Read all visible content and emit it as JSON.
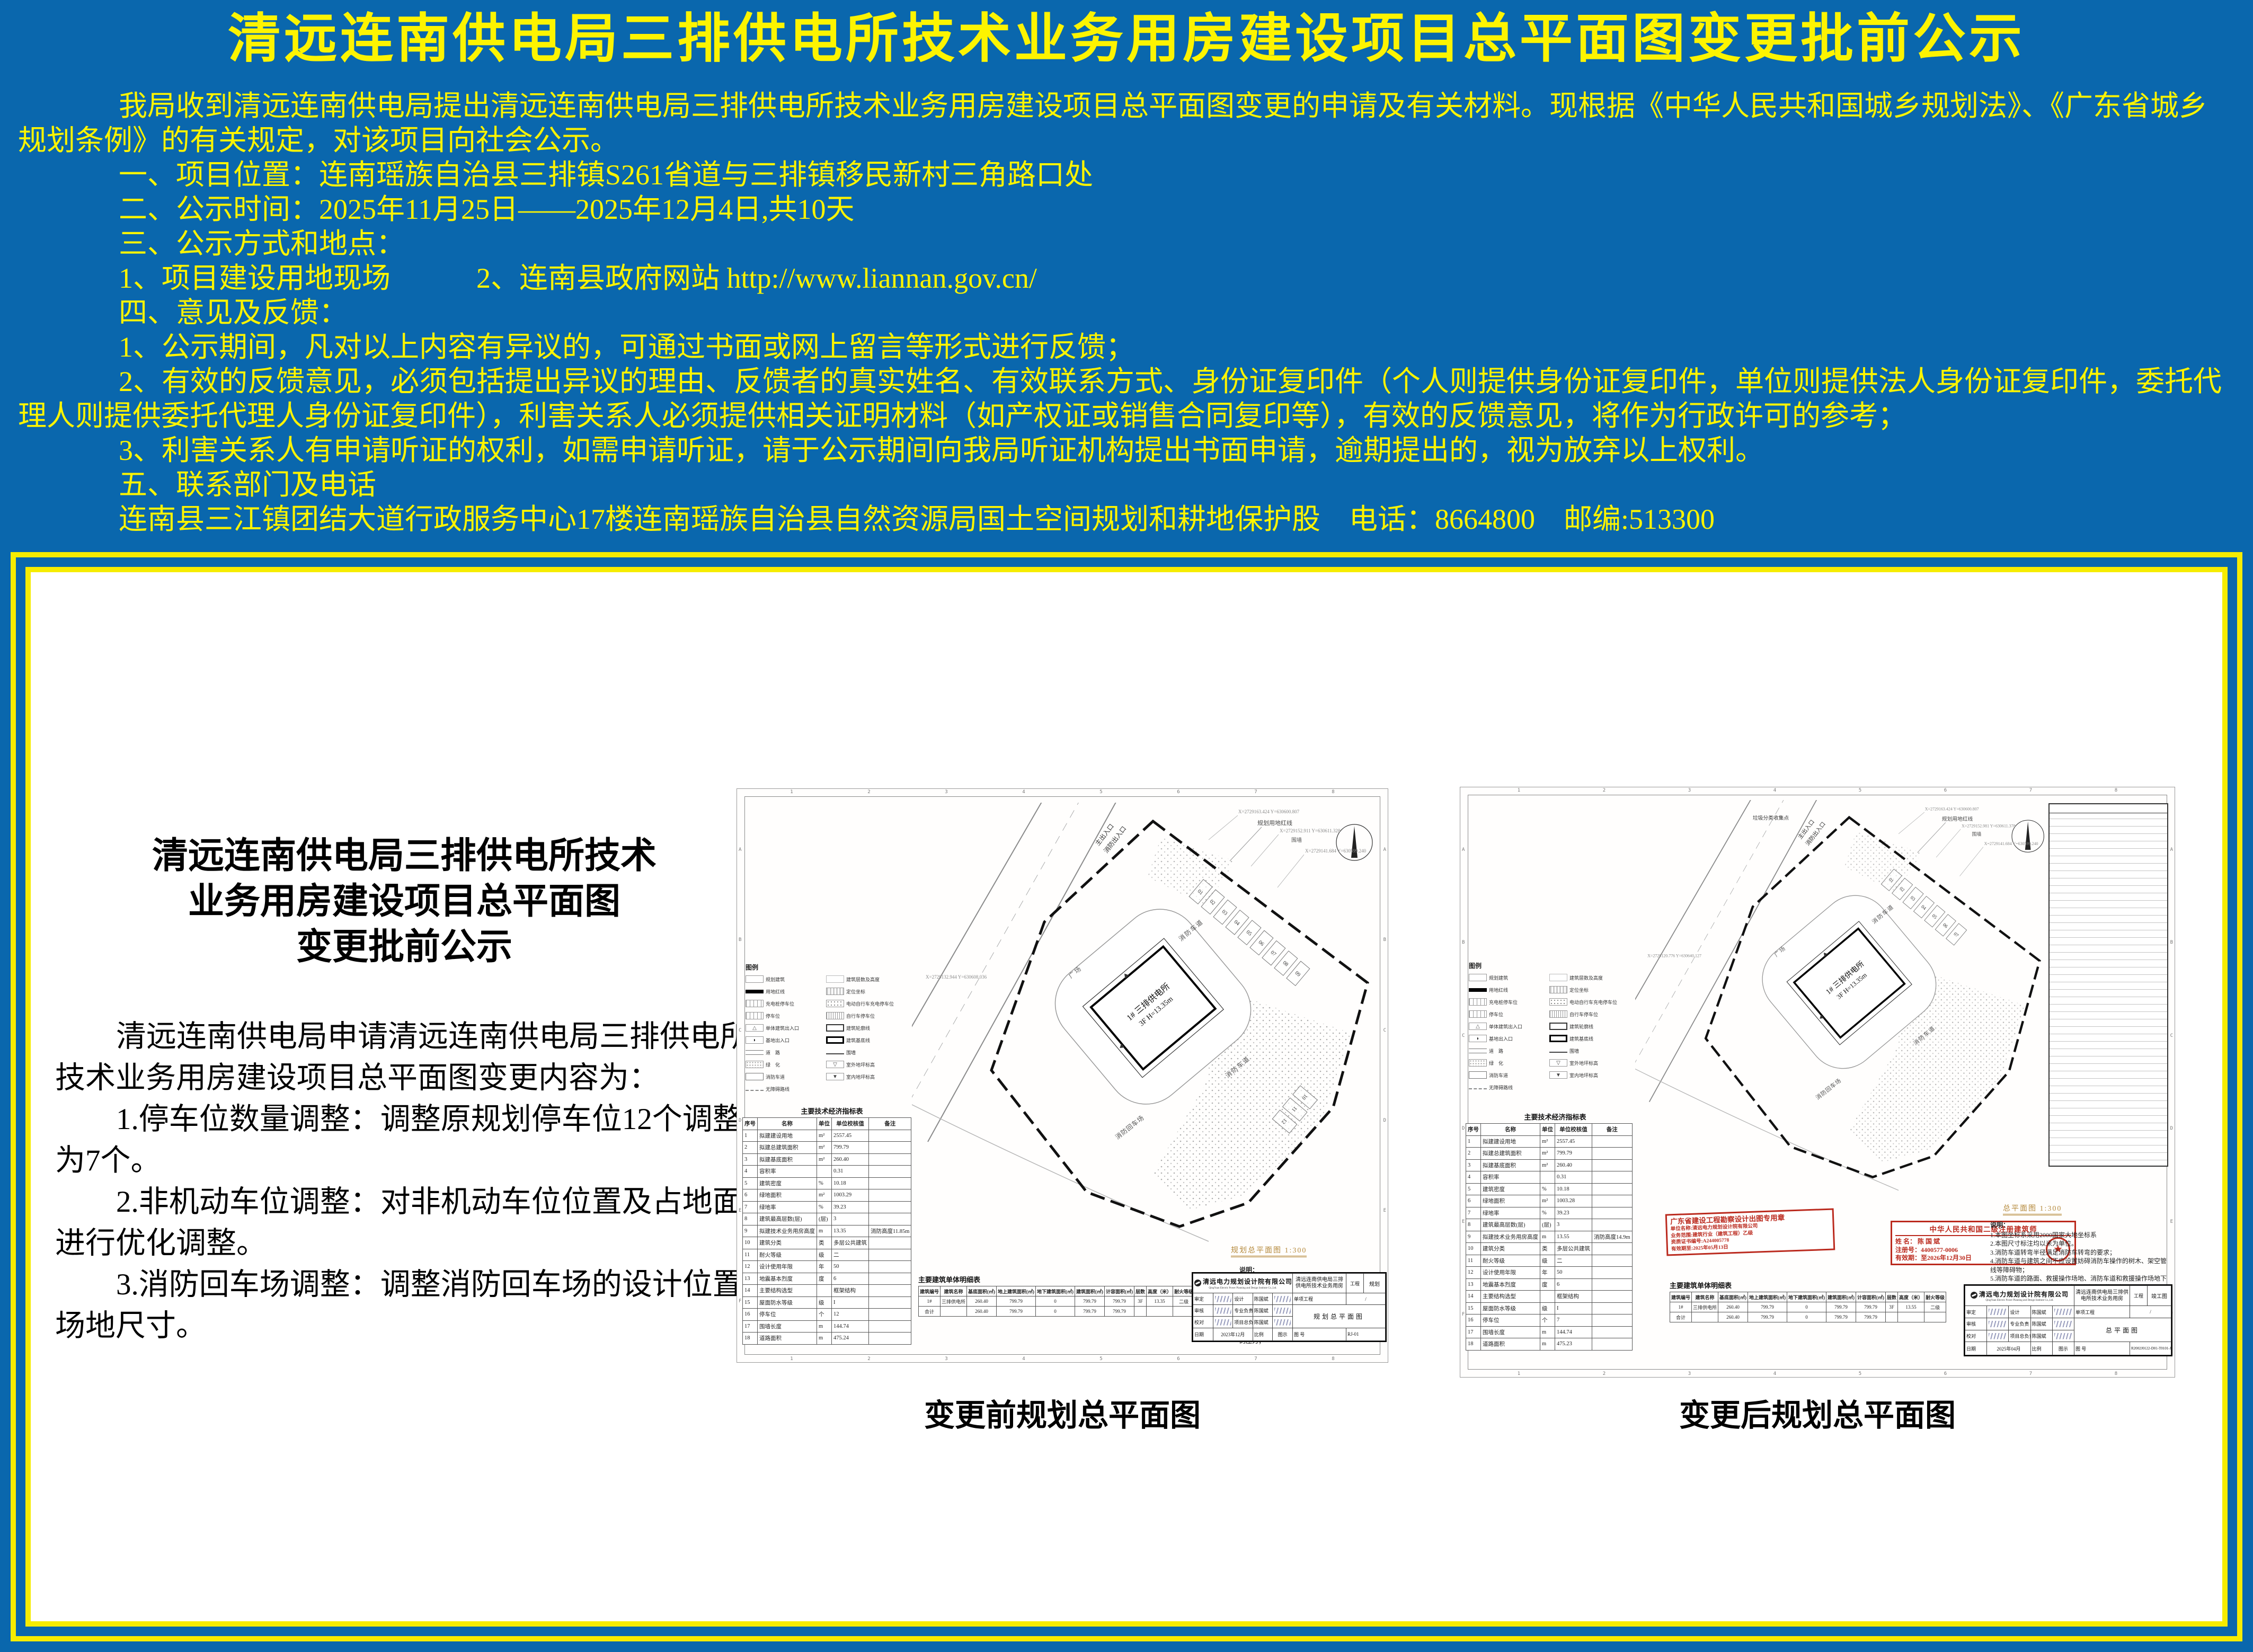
{
  "colors": {
    "background_blue": "#0a67ad",
    "accent_yellow": "#fdf400",
    "stamp_red": "#bb2a1e",
    "panel_border_yellow": "#f6ec00"
  },
  "notice": {
    "title": "清远连南供电局三排供电所技术业务用房建设项目总平面图变更批前公示",
    "intro": "我局收到清远连南供电局提出清远连南供电局三排供电所技术业务用房建设项目总平面图变更的申请及有关材料。现根据《中华人民共和国城乡规划法》、《广东省城乡规划条例》的有关规定，对该项目向社会公示。",
    "items": [
      "一、项目位置：连南瑶族自治县三排镇S261省道与三排镇移民新村三角路口处",
      "二、公示时间：2025年11月25日——2025年12月4日,共10天",
      "三、公示方式和地点：",
      "1、项目建设用地现场　　　2、连南县政府网站 http://www.liannan.gov.cn/",
      "四、意见及反馈：",
      "1、公示期间，凡对以上内容有异议的，可通过书面或网上留言等形式进行反馈；",
      "2、有效的反馈意见，必须包括提出异议的理由、反馈者的真实姓名、有效联系方式、身份证复印件（个人则提供身份证复印件，单位则提供法人身份证复印件，委托代理人则提供委托代理人身份证复印件），利害关系人必须提供相关证明材料（如产权证或销售合同复印等），有效的反馈意见，将作为行政许可的参考；",
      "3、利害关系人有申请听证的权利，如需申请听证，请于公示期间向我局听证机构提出书面申请，逾期提出的，视为放弃以上权利。",
      "五、联系部门及电话",
      "连南县三江镇团结大道行政服务中心17楼连南瑶族自治县自然资源局国土空间规划和耕地保护股　电话：8664800　邮编:513300"
    ]
  },
  "panel": {
    "heading_lines": [
      "清远连南供电局三排供电所技术",
      "业务用房建设项目总平面图",
      "变更批前公示"
    ],
    "body_intro": "清远连南供电局申请清远连南供电局三排供电所技术业务用房建设项目总平面图变更内容为：",
    "changes": [
      "1.停车位数量调整：调整原规划停车位12个调整后为7个。",
      "2.非机动车位调整：对非机动车位位置及占地面积进行优化调整。",
      "3.消防回车场调整：调整消防回车场的设计位置与场地尺寸。"
    ],
    "caption_before": "变更前规划总平面图",
    "caption_after": "变更后规划总平面图"
  },
  "grid": {
    "cols": [
      "1",
      "2",
      "3",
      "4",
      "5",
      "6",
      "7",
      "8"
    ],
    "rows": [
      "A",
      "B",
      "C",
      "D",
      "E",
      "F"
    ]
  },
  "legend_title": "图例",
  "legend": [
    {
      "type": "box",
      "label": "规划建筑"
    },
    {
      "type": "tag",
      "label": "建筑层数及高度"
    },
    {
      "type": "thickline",
      "label": "用地红线"
    },
    {
      "type": "hatchbox",
      "label": "定位坐标"
    },
    {
      "type": "stall",
      "label": "充电桩停车位"
    },
    {
      "type": "dotsbox",
      "label": "电动自行车充电停车位"
    },
    {
      "type": "stall",
      "label": "停车位"
    },
    {
      "type": "ticksbox",
      "label": "自行车停车位"
    },
    {
      "type": "tri",
      "label": "单体建筑出入口"
    },
    {
      "type": "outline",
      "label": "建筑轮廓线"
    },
    {
      "type": "entr",
      "label": "基地出入口"
    },
    {
      "type": "outline2",
      "label": "建筑基底线"
    },
    {
      "type": "road",
      "label": "道　路"
    },
    {
      "type": "line",
      "label": "围墙"
    },
    {
      "type": "dots",
      "label": "绿　化"
    },
    {
      "type": "level",
      "label": "室外地坪标高"
    },
    {
      "type": "firelane",
      "label": "消防车道"
    },
    {
      "type": "level2",
      "label": "室内地坪标高"
    },
    {
      "type": "dash",
      "label": "无障碍路线"
    }
  ],
  "plan_notes_title": "说明：",
  "plan_notes": [
    "1.本图坐标系采用2000国家大地坐标系",
    "2.本图尺寸标注均以米为单位。",
    "3.消防车道转弯半径满足消防车转弯的要求；",
    "4.消防车道与建筑之间不应设置妨碍消防车操作的树木、架空管线等障碍物；",
    "5.消防车道的路面、救援操作场地、消防车道和救援操作场地下面的管道和暗沟等，应能承受重型消防车的压力；"
  ],
  "drawing_before": {
    "indicators": {
      "title": "主要技术经济指标表",
      "header": [
        "序号",
        "名称",
        "单位",
        "单位校核值",
        "备注"
      ],
      "rows": [
        [
          "1",
          "拟建建设用地",
          "m²",
          "2557.45",
          ""
        ],
        [
          "2",
          "拟建总建筑面积",
          "m²",
          "799.79",
          ""
        ],
        [
          "3",
          "拟建基底面积",
          "m²",
          "260.40",
          ""
        ],
        [
          "4",
          "容积率",
          "",
          "0.31",
          ""
        ],
        [
          "5",
          "建筑密度",
          "%",
          "10.18",
          ""
        ],
        [
          "6",
          "绿地面积",
          "m²",
          "1003.29",
          ""
        ],
        [
          "7",
          "绿地率",
          "%",
          "39.23",
          ""
        ],
        [
          "8",
          "建筑最高层数(层)",
          "(层)",
          "3",
          ""
        ],
        [
          "9",
          "拟建技术业务用房高度",
          "m",
          "13.35",
          "消防高度11.85m"
        ],
        [
          "10",
          "建筑分类",
          "类",
          "多层公共建筑",
          ""
        ],
        [
          "11",
          "耐火等级",
          "级",
          "二",
          ""
        ],
        [
          "12",
          "设计使用年限",
          "年",
          "50",
          ""
        ],
        [
          "13",
          "地震基本烈度",
          "度",
          "6",
          ""
        ],
        [
          "14",
          "主要结构选型",
          "",
          "框架结构",
          ""
        ],
        [
          "15",
          "屋面防水等级",
          "级",
          "I",
          ""
        ],
        [
          "16",
          "停车位",
          "个",
          "12",
          ""
        ],
        [
          "17",
          "围墙长度",
          "m",
          "144.74",
          ""
        ],
        [
          "18",
          "道路面积",
          "m",
          "475.24",
          ""
        ]
      ]
    },
    "buildings": {
      "title": "主要建筑单体明细表",
      "header": [
        "建筑编号",
        "建筑名称",
        "基底面积(㎡)",
        "地上建筑面积(㎡)",
        "地下建筑面积(㎡)",
        "建筑面积(㎡)",
        "计容面积(㎡)",
        "层数",
        "高度（米）",
        "耐火等级"
      ],
      "rows": [
        [
          "1#",
          "三排供电所",
          "260.40",
          "799.79",
          "0",
          "799.79",
          "799.79",
          "3F",
          "13.35",
          "二级"
        ],
        [
          "合计",
          "",
          "260.40",
          "799.79",
          "0",
          "799.79",
          "799.79",
          "",
          "",
          ""
        ]
      ]
    },
    "scale_label": "规划总平面图 1:300",
    "tb": {
      "company": "清远电力规划设计院有限公司",
      "company_en": "QingYuan Electric Power Planning and Design Institute Co.,Ltd.",
      "project": "清远连南供电局三排供电所技术业务用房",
      "tag": "工程",
      "stage": "规划",
      "sub_label": "单项工程",
      "sub_value": "/",
      "dwg": "规划总平面图",
      "r1a": "审定",
      "r1b": "设计",
      "r1c": "陈国斌",
      "r2a": "审核",
      "r2b": "专业负责",
      "r2c": "陈国斌",
      "r3a": "校对",
      "r3b": "项目总负责",
      "r3c": "陈国斌",
      "date_label": "日期",
      "date": "2023年12月",
      "scale_label": "比例",
      "scale_value": "图示",
      "no_label": "图 号",
      "no_value": "RJ-01"
    },
    "plan": {
      "entrance1": "主出入口",
      "entrance2": "消防出入口",
      "redline_label": "规划用地红线",
      "wall_label": "围墙",
      "extra_label": "",
      "road_labels": [
        "消防车道",
        "消防车道",
        "消防回车场",
        "广场"
      ],
      "building_line1": "1# 三排供电所",
      "building_line2": "3F H=13.35m",
      "parking_main": [
        "01",
        "02",
        "03",
        "04",
        "05",
        "06",
        "07",
        "08",
        "09"
      ],
      "parking_extra": [
        "10",
        "11",
        "12"
      ],
      "coords": [
        "X=2729163.424 Y=630600.807",
        "X=2729152.911 Y=630611.328",
        "X=2729141.684 Y=630599.240",
        "X=2729132.944 Y=630608.036"
      ]
    }
  },
  "drawing_after": {
    "indicators": {
      "title": "主要技术经济指标表",
      "header": [
        "序号",
        "名称",
        "单位",
        "单位校核值",
        "备注"
      ],
      "rows": [
        [
          "1",
          "拟建建设用地",
          "m²",
          "2557.45",
          ""
        ],
        [
          "2",
          "拟建总建筑面积",
          "m²",
          "799.79",
          ""
        ],
        [
          "3",
          "拟建基底面积",
          "m²",
          "260.40",
          ""
        ],
        [
          "4",
          "容积率",
          "",
          "0.31",
          ""
        ],
        [
          "5",
          "建筑密度",
          "%",
          "10.18",
          ""
        ],
        [
          "6",
          "绿地面积",
          "m²",
          "1003.28",
          ""
        ],
        [
          "7",
          "绿地率",
          "%",
          "39.23",
          ""
        ],
        [
          "8",
          "建筑最高层数(层)",
          "(层)",
          "3",
          ""
        ],
        [
          "9",
          "拟建技术业务用房高度",
          "m",
          "13.55",
          "消防高度14.9m"
        ],
        [
          "10",
          "建筑分类",
          "类",
          "多层公共建筑",
          ""
        ],
        [
          "11",
          "耐火等级",
          "级",
          "二",
          ""
        ],
        [
          "12",
          "设计使用年限",
          "年",
          "50",
          ""
        ],
        [
          "13",
          "地震基本烈度",
          "度",
          "6",
          ""
        ],
        [
          "14",
          "主要结构选型",
          "",
          "框架结构",
          ""
        ],
        [
          "15",
          "屋面防水等级",
          "级",
          "I",
          ""
        ],
        [
          "16",
          "停车位",
          "个",
          "7",
          ""
        ],
        [
          "17",
          "围墙长度",
          "m",
          "144.74",
          ""
        ],
        [
          "18",
          "道路面积",
          "m",
          "475.23",
          ""
        ]
      ]
    },
    "buildings": {
      "title": "主要建筑单体明细表",
      "header": [
        "建筑编号",
        "建筑名称",
        "基底面积(㎡)",
        "地上建筑面积(㎡)",
        "地下建筑面积(㎡)",
        "建筑面积(㎡)",
        "计容面积(㎡)",
        "层数",
        "高度（米）",
        "耐火等级"
      ],
      "rows": [
        [
          "1#",
          "三排供电所",
          "260.40",
          "799.79",
          "0",
          "799.79",
          "799.79",
          "3F",
          "13.55",
          "二级"
        ],
        [
          "合计",
          "",
          "260.40",
          "799.79",
          "0",
          "799.79",
          "799.79",
          "",
          "",
          ""
        ]
      ]
    },
    "scale_label": "总平面图 1:300",
    "stamp1_lines": [
      "广东省建设工程勘察设计出图专用章",
      "单位名称:清远电力规划设计院有限公司",
      "业务范围:建筑行业（建筑工程）乙级",
      "资质证书编号:A244005778",
      "有效期至:2025年05月13日"
    ],
    "stamp2": {
      "title": "中华人民共和国二级注册建筑师",
      "name": "姓 名： 陈 国 斌",
      "reg": "注册号：4400577-0006",
      "valid": "有效期：至2026年12月30日"
    },
    "tb": {
      "company": "清远电力规划设计院有限公司",
      "company_en": "QingYuan Electric Power Planning and Design Institute Co.,Ltd.",
      "project": "清远连南供电局三排供电所技术业务用房",
      "tag": "工程",
      "stage": "竣工图",
      "sub_label": "单项工程",
      "sub_value": "/",
      "dwg": "总平面图",
      "r1a": "审定",
      "r1b": "设计",
      "r1c": "陈国斌",
      "r2a": "审核",
      "r2b": "专业负责",
      "r2c": "陈国斌",
      "r3a": "校对",
      "r3b": "项目总负责",
      "r3c": "陈国斌",
      "date_label": "日期",
      "date": "2025年04月",
      "scale_label": "比例",
      "scale_value": "图示",
      "no_label": "图 号",
      "no_value": "R2002J0122-D01-T0101-JS-11A"
    },
    "plan": {
      "entrance1": "主出入口",
      "entrance2": "消防出入口",
      "redline_label": "规划用地红线",
      "wall_label": "围墙",
      "extra_label": "垃圾分类收集点",
      "road_labels": [
        "消防车道",
        "消防车道",
        "消防回车场",
        "广场"
      ],
      "building_line1": "1# 三排供电所",
      "building_line2": "3F H=13.35m",
      "parking_main": [
        "01",
        "02",
        "03",
        "04",
        "05",
        "06",
        "07"
      ],
      "parking_extra": [],
      "coords": [
        "X=2729163.424 Y=630600.807",
        "X=2729152.981 Y=630611.378",
        "X=2729141.684 Y=630599.240",
        "X=2729120.776 Y=630640.127"
      ]
    }
  }
}
